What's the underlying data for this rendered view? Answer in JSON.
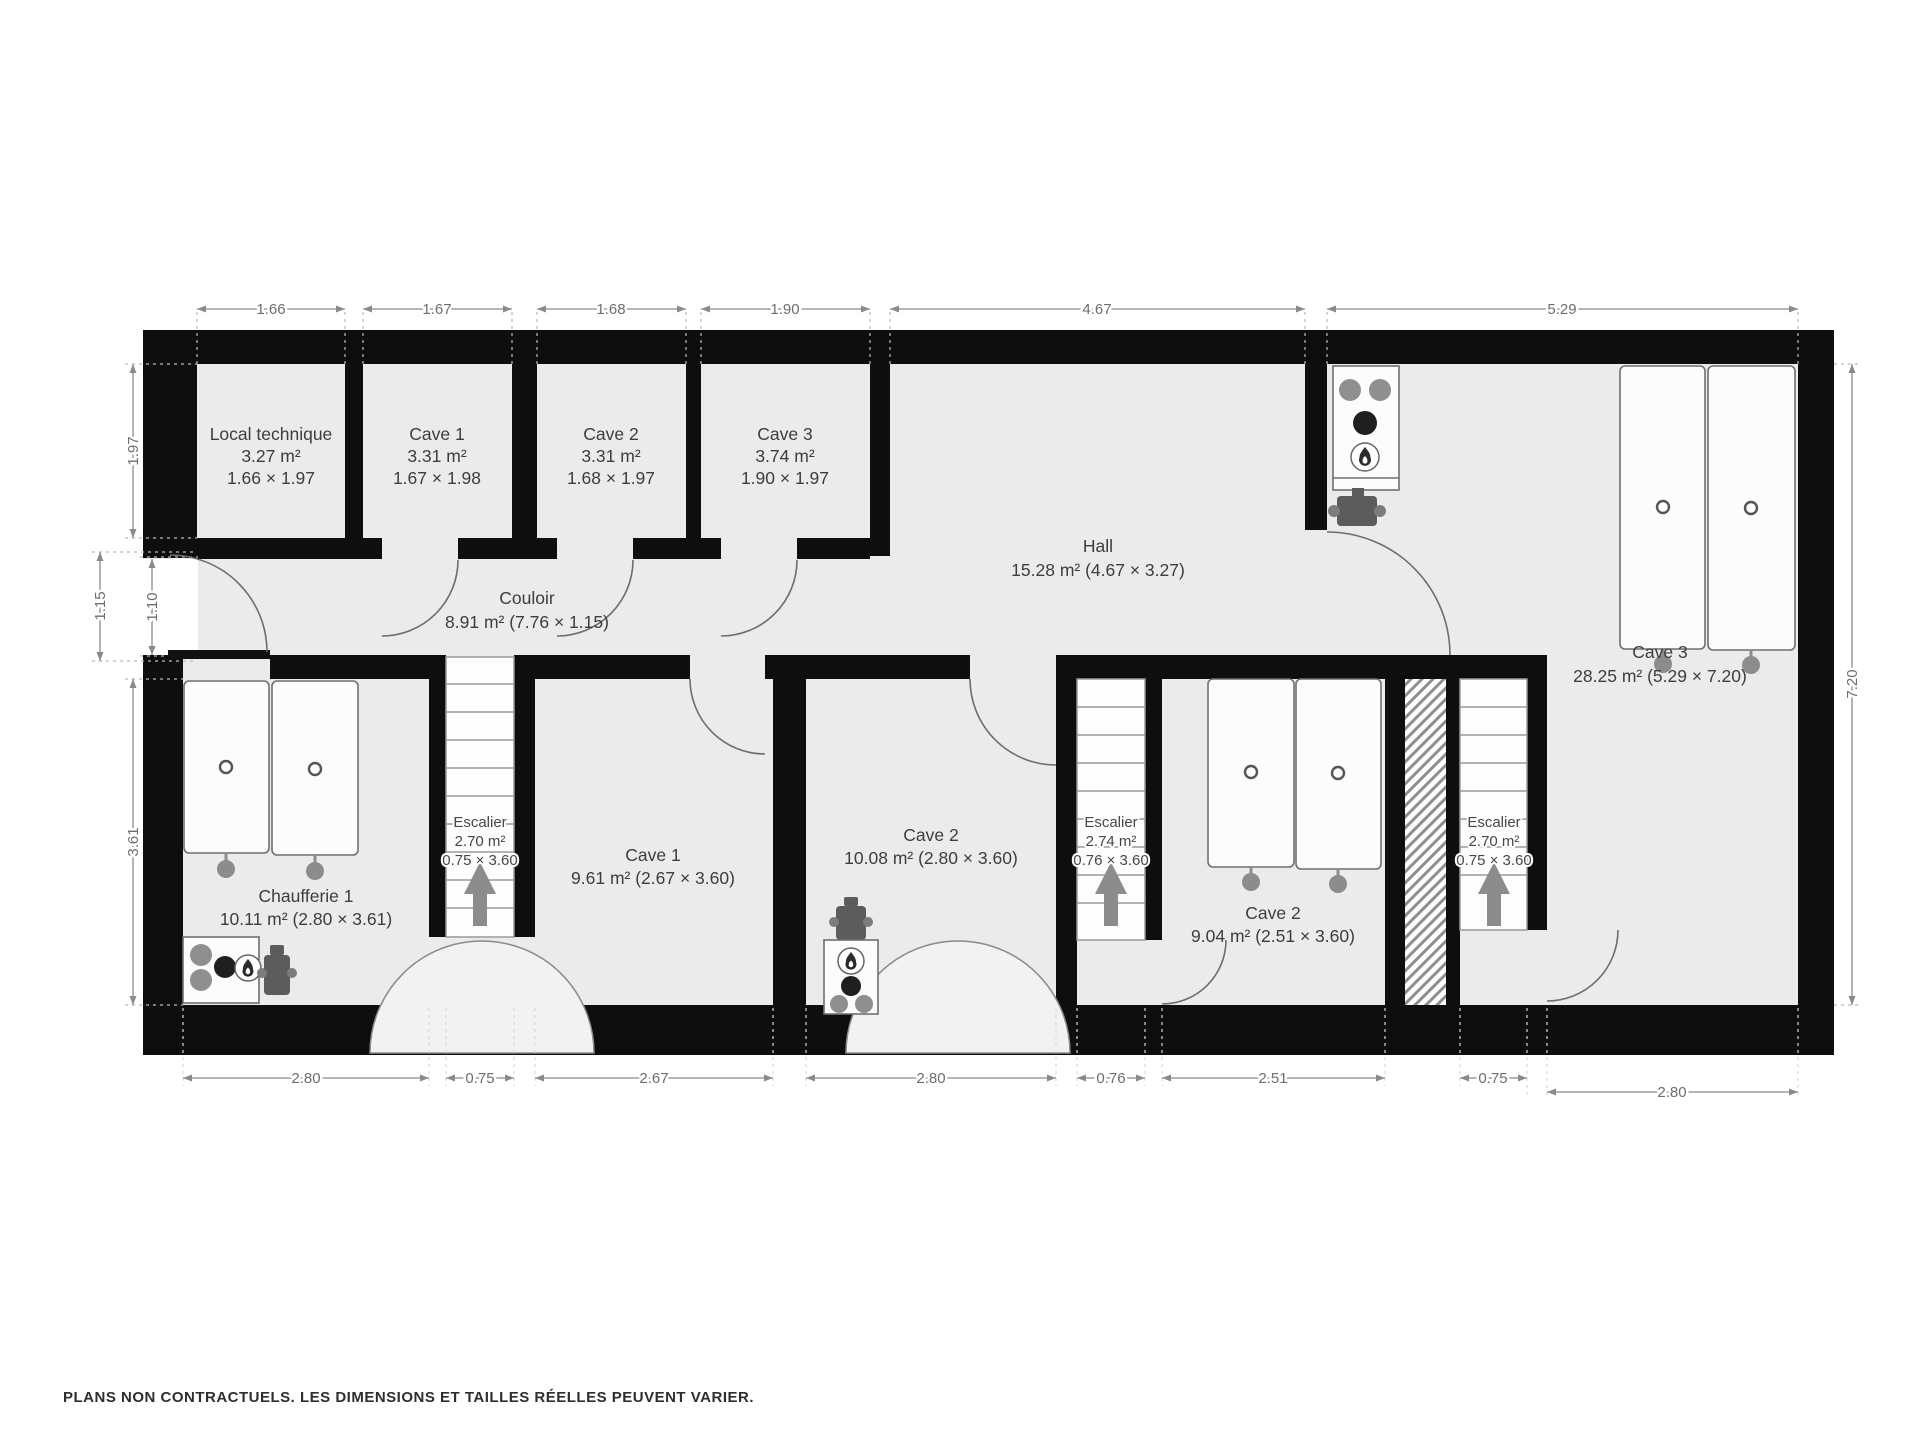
{
  "rooms": {
    "localTechnique": {
      "name": "Local technique",
      "area": "3.27 m²",
      "size": "1.66 × 1.97"
    },
    "cave1Top": {
      "name": "Cave 1",
      "area": "3.31 m²",
      "size": "1.67 × 1.98"
    },
    "cave2Top": {
      "name": "Cave 2",
      "area": "3.31 m²",
      "size": "1.68 × 1.97"
    },
    "cave3Top": {
      "name": "Cave 3",
      "area": "3.74 m²",
      "size": "1.90 × 1.97"
    },
    "hall": {
      "name": "Hall",
      "area_dims": "15.28 m² (4.67 × 3.27)"
    },
    "couloir": {
      "name": "Couloir",
      "area_dims": "8.91 m² (7.76 × 1.15)"
    },
    "cave3Right": {
      "name": "Cave 3",
      "area_dims": "28.25 m² (5.29 × 7.20)"
    },
    "chaufferie": {
      "name": "Chaufferie 1",
      "area_dims": "10.11 m² (2.80 × 3.61)"
    },
    "cave1Bottom": {
      "name": "Cave 1",
      "area_dims": "9.61 m² (2.67 × 3.60)"
    },
    "cave2Mid": {
      "name": "Cave 2",
      "area_dims": "10.08 m² (2.80 × 3.60)"
    },
    "cave2Right": {
      "name": "Cave 2",
      "area_dims": "9.04 m² (2.51 × 3.60)"
    },
    "escalier1": {
      "name": "Escalier",
      "area": "2.70 m²",
      "size": "0.75 × 3.60"
    },
    "escalier2": {
      "name": "Escalier",
      "area": "2.74 m²",
      "size": "0.76 × 3.60"
    },
    "escalier3": {
      "name": "Escalier",
      "area": "2.70 m²",
      "size": "0.75 × 3.60"
    }
  },
  "dimensions": {
    "top": [
      "1.66",
      "1.67",
      "1.68",
      "1.90",
      "4.67",
      "5.29"
    ],
    "bottom": [
      "2.80",
      "0.75",
      "2.67",
      "2.80",
      "0.76",
      "2.51",
      "0.75",
      "2.80"
    ],
    "left": [
      "1.97",
      "1.15",
      "1.10",
      "3.61"
    ],
    "right": [
      "7.20"
    ]
  },
  "footer": {
    "disclaimer": "PLANS NON CONTRACTUELS. LES DIMENSIONS ET TAILLES RÉELLES PEUVENT VARIER."
  },
  "colors": {
    "wall": "#0e0e0e",
    "room_fill": "#ebebeb",
    "dimension_text": "#6e6e6e",
    "label_text": "#3d3d3d"
  }
}
